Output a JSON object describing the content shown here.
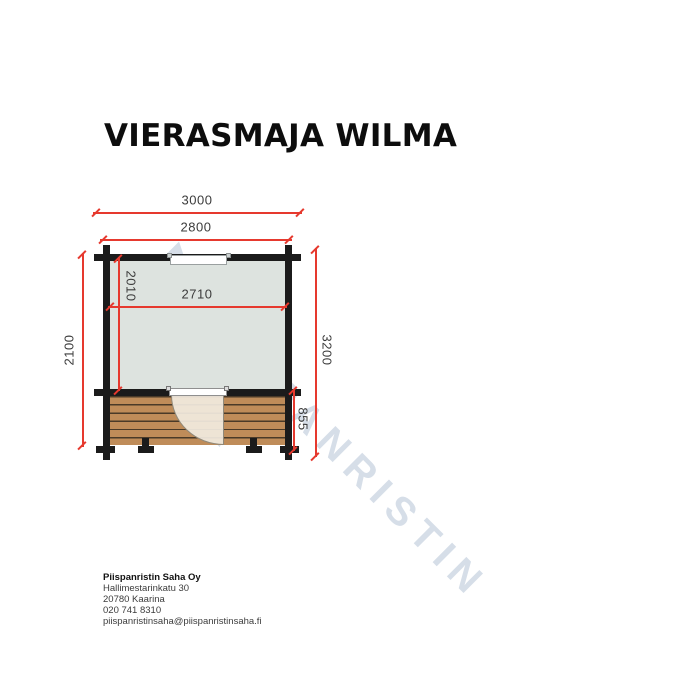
{
  "title": "VIERASMAJA WILMA",
  "plan": {
    "dim_overall_width": "3000",
    "dim_wall_width": "2800",
    "dim_left_depth": "2100",
    "dim_total_depth": "3200",
    "dim_interior_depth": "2010",
    "dim_interior_width": "2710",
    "dim_terrace_depth": "855"
  },
  "watermark": {
    "brand_line1": "PIISPANRISTIN",
    "brand_line2": "SAHA"
  },
  "footer": {
    "company": "Piispanristin Saha Oy",
    "street": "Hallimestarinkatu 30",
    "city": "20780 Kaarina",
    "phone": "020 741 8310",
    "email": "piispanristinsaha@piispanristinsaha.fi"
  },
  "colors": {
    "dimension_red": "#e6392e",
    "wall_black": "#1b1b1b",
    "interior_fill": "#dde3df",
    "deck_wood": "#bf8c59",
    "watermark_blue": "#bcc9da"
  }
}
